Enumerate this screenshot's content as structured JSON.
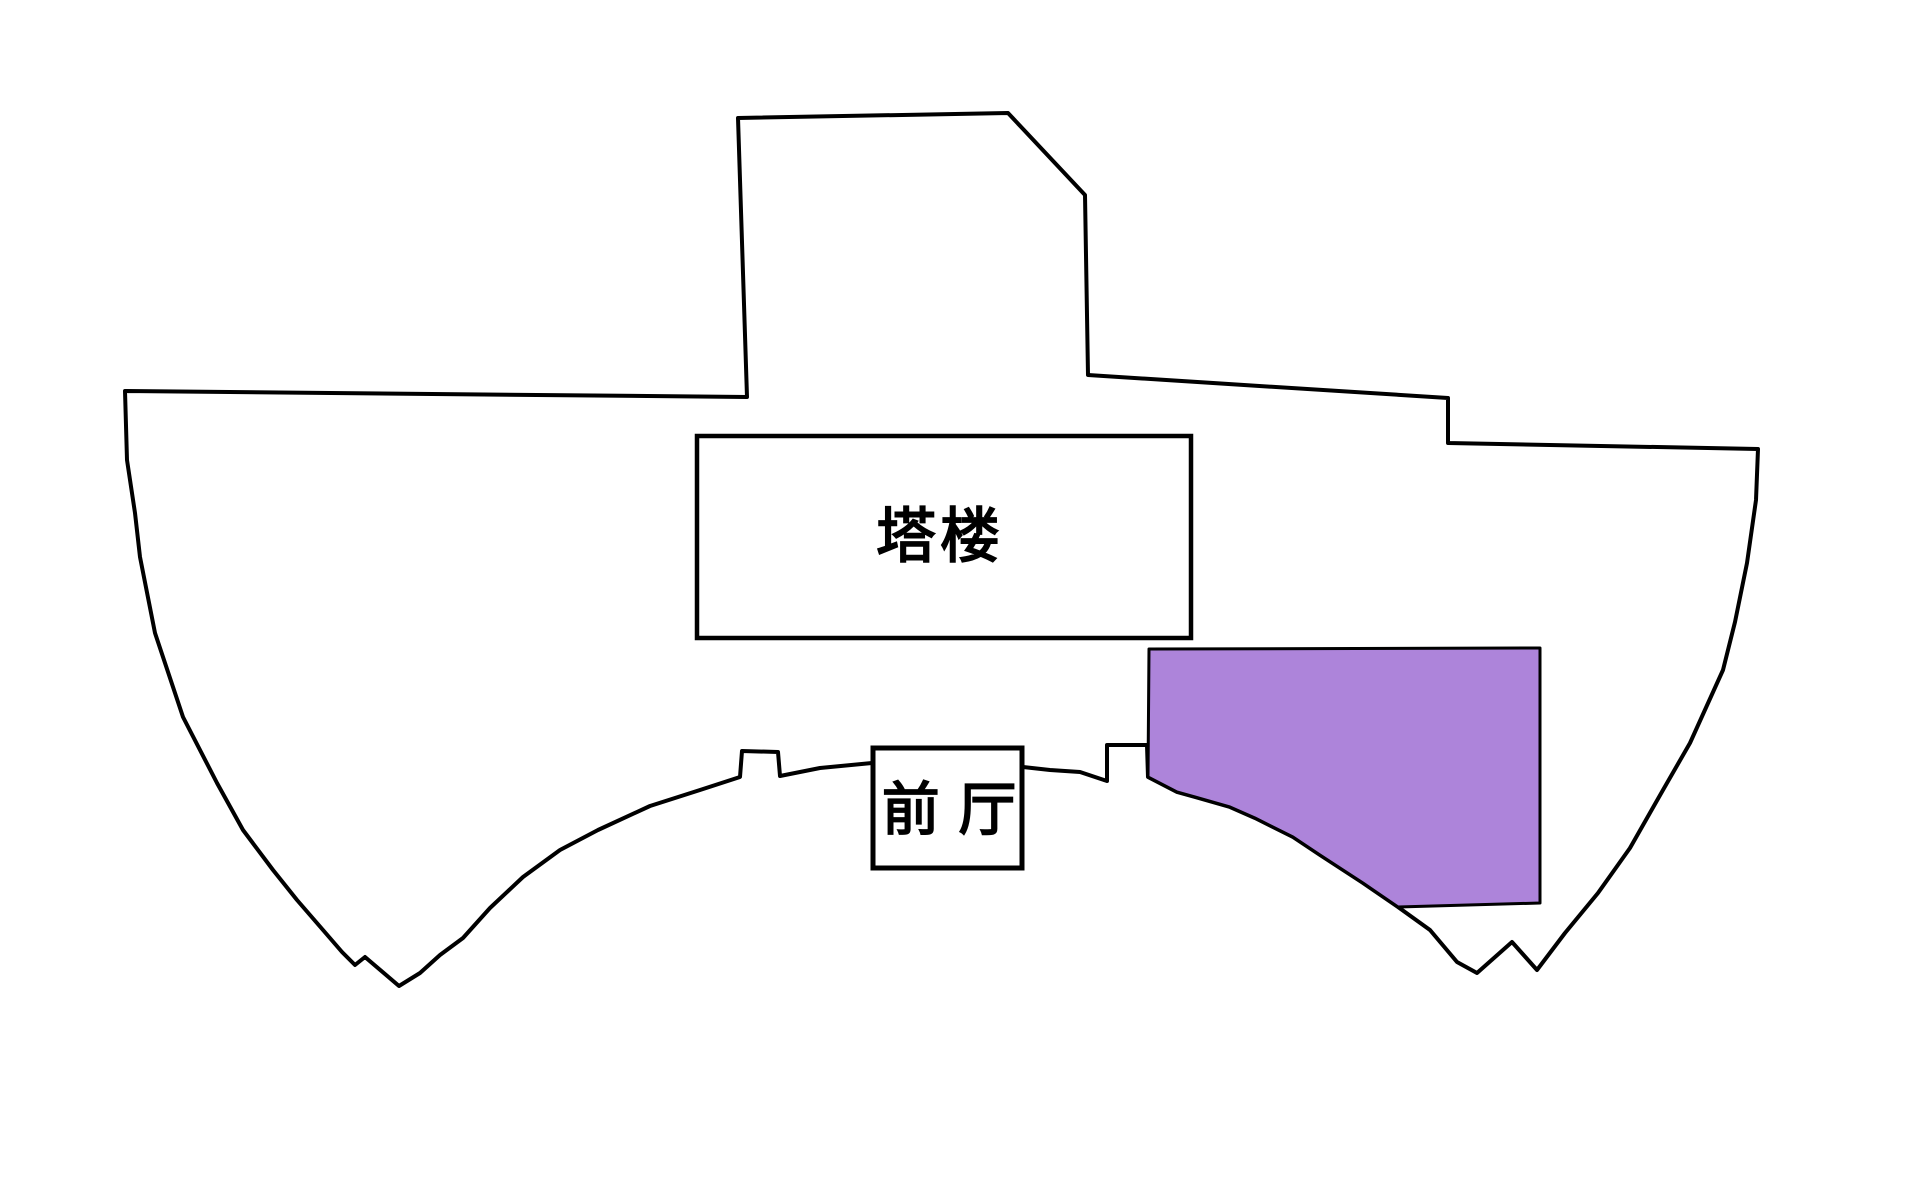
{
  "page": {
    "background": "#ffffff"
  },
  "diagram": {
    "kind": "building-floor-plan",
    "labels": {
      "tower": "塔楼",
      "front_hall": "前 厅"
    },
    "colors": {
      "highlight_fill": "#ad84da",
      "line": "#000000",
      "room_fill": "#ffffff"
    }
  }
}
